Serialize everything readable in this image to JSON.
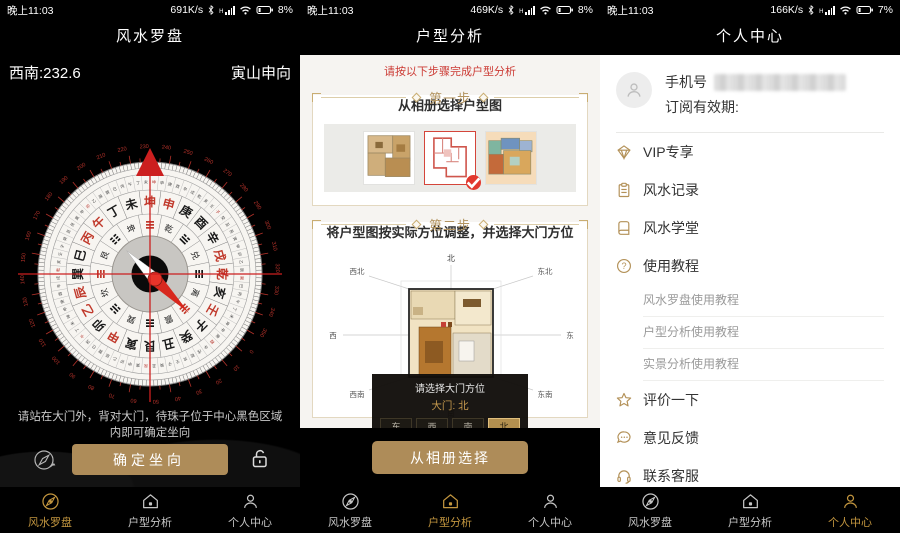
{
  "colors": {
    "gold_button": "#ae8c59",
    "nav_active": "#c3963f",
    "red_accent": "#cc3b35",
    "icon_gold": "#b39158"
  },
  "status": {
    "left_time": "晚上11:03",
    "panels": [
      {
        "speed": "691K/s",
        "battery": "8%"
      },
      {
        "speed": "469K/s",
        "battery": "8%"
      },
      {
        "speed": "166K/s",
        "battery": "7%"
      }
    ]
  },
  "nav": {
    "items": [
      {
        "label": "风水罗盘"
      },
      {
        "label": "户型分析"
      },
      {
        "label": "个人中心"
      }
    ]
  },
  "compass_screen": {
    "title": "风水罗盘",
    "heading": "西南:232.6",
    "sitting_facing": "寅山申向",
    "instruction_line1": "请站在大门外，背对大门，待珠子位于中心黑色区域",
    "instruction_line2": "内即可确定坐向",
    "confirm_label": "确定坐向",
    "top_degree": 232.6,
    "mountains": [
      "坤",
      "申",
      "庚",
      "酉",
      "辛",
      "戌",
      "乾",
      "亥",
      "壬",
      "子",
      "癸",
      "丑",
      "艮",
      "寅",
      "甲",
      "卯",
      "乙",
      "辰",
      "巽",
      "巳",
      "丙",
      "午",
      "丁",
      "未"
    ],
    "red_mountains": [
      "坤",
      "申",
      "午",
      "丙",
      "壬",
      "乾",
      "戌",
      "乙",
      "辰",
      "甲"
    ],
    "inner_ring": [
      {
        "name": "乾",
        "bars": [
          1,
          1,
          1
        ]
      },
      {
        "name": "兑",
        "bars": [
          0,
          1,
          1
        ]
      },
      {
        "name": "离",
        "bars": [
          1,
          0,
          1
        ]
      },
      {
        "name": "震",
        "bars": [
          0,
          0,
          1
        ]
      },
      {
        "name": "巽",
        "bars": [
          1,
          1,
          0
        ]
      },
      {
        "name": "坎",
        "bars": [
          0,
          1,
          0
        ]
      },
      {
        "name": "艮",
        "bars": [
          1,
          0,
          0
        ]
      },
      {
        "name": "坤",
        "bars": [
          0,
          0,
          0
        ]
      }
    ]
  },
  "plan_screen": {
    "title": "户型分析",
    "tip": "请按以下步骤完成户型分析",
    "step1": {
      "label": "第一步",
      "desc": "从相册选择户型图"
    },
    "step2": {
      "label": "第二步",
      "desc": "将户型图按实际方位调整，并选择大门方位"
    },
    "selected_thumbnail_index": 1,
    "directions": {
      "n": "北",
      "ne": "东北",
      "e": "东",
      "se": "东南",
      "s": "南",
      "sw": "西南",
      "w": "西",
      "nw": "西北"
    },
    "door_dialog": {
      "title": "请选择大门方位",
      "door_label": "大门:",
      "door_value": "北",
      "options": [
        "东",
        "西",
        "南",
        "北"
      ],
      "selected": "北"
    },
    "gallery_button": "从相册选择"
  },
  "profile_screen": {
    "title": "个人中心",
    "phone_label": "手机号",
    "subscription_label": "订阅有效期:",
    "menu": [
      {
        "icon": "vip-diamond-icon",
        "label": "VIP专享"
      },
      {
        "icon": "record-clipboard-icon",
        "label": "风水记录"
      },
      {
        "icon": "school-book-icon",
        "label": "风水学堂"
      },
      {
        "icon": "tutorial-question-icon",
        "label": "使用教程"
      }
    ],
    "tutorials": [
      {
        "label": "风水罗盘使用教程"
      },
      {
        "label": "户型分析使用教程"
      },
      {
        "label": "实景分析使用教程"
      }
    ],
    "menu_secondary": [
      {
        "icon": "star-icon",
        "label": "评价一下"
      },
      {
        "icon": "feedback-chat-icon",
        "label": "意见反馈"
      },
      {
        "icon": "support-headset-icon",
        "label": "联系客服"
      }
    ]
  }
}
